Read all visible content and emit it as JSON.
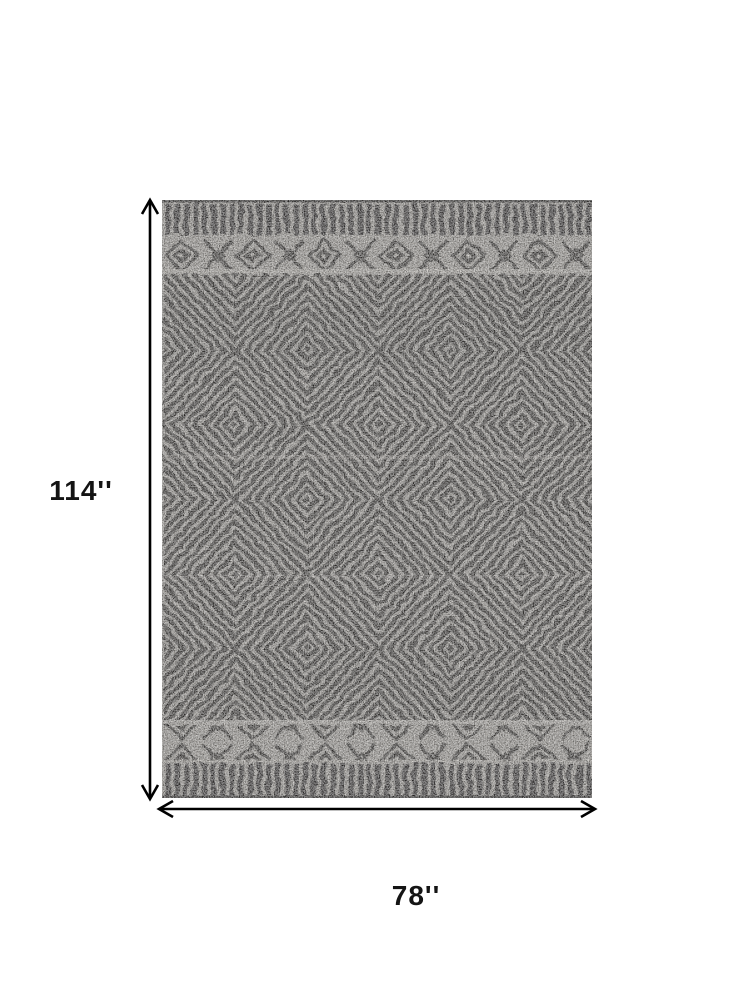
{
  "image": {
    "subject": "Gray and black geometric diamond pattern area rug with dimension arrows"
  },
  "dimensions": {
    "height": {
      "label": "114''",
      "value": 114
    },
    "width": {
      "label": "78''",
      "value": 78
    },
    "unit": "inches"
  },
  "colors": {
    "page_background": "#ffffff",
    "arrow": "#000000",
    "label_text": "#141414",
    "rug_ground": "#b2aea8",
    "rug_dark": "#3b3936",
    "rug_bar": "#343230",
    "rug_light": "#c6c2bb",
    "rug_edge": "#2d2b29"
  }
}
